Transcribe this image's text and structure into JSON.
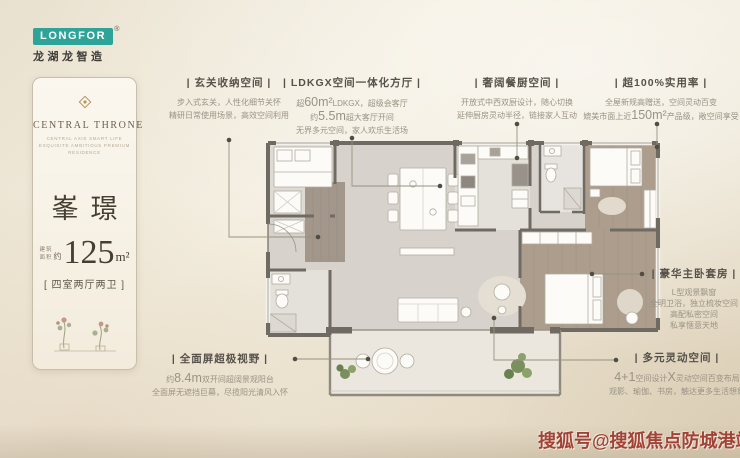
{
  "colors": {
    "logo_teal": "#2ea397",
    "watermark_red": "#9e372b",
    "title_text": "#56514a",
    "body_text": "#9a9384"
  },
  "logo": {
    "wordmark": "LONGFOR",
    "registered": "®",
    "subtitle": "龙湖龙智造"
  },
  "card": {
    "brand": "CENTRAL THRONE",
    "tagline1": "CENTRAL AXIS SMART LIFE",
    "tagline2": "EXQUISITE AMBITIOUS PREMIUM RESIDENCE",
    "name": "峯璟",
    "area_label_1": "建筑",
    "area_label_2": "面积",
    "area_approx": "约",
    "area_value": "125",
    "area_unit": "m²",
    "layout": "[ 四室两厅两卫 ]"
  },
  "annotations": [
    {
      "id": "entry-storage",
      "title": "| 玄关收纳空间 |",
      "lines": [
        [
          {
            "t": "步入式玄关，人性化细节关怀"
          }
        ],
        [
          {
            "t": "精研日常使用场景，高效空间利用"
          }
        ]
      ]
    },
    {
      "id": "ldkgx-hall",
      "title": "| LDKGX空间一体化方厅 |",
      "lines": [
        [
          {
            "t": "超"
          },
          {
            "t": "60m²",
            "big": true
          },
          {
            "t": "LDKGX，超级会客厅"
          }
        ],
        [
          {
            "t": "约"
          },
          {
            "t": "5.5m",
            "big": true
          },
          {
            "t": "超大客厅开间"
          }
        ],
        [
          {
            "t": "无界多元空间，家人欢乐生活场"
          }
        ]
      ]
    },
    {
      "id": "kitchen-dining",
      "title": "| 奢阔餐厨空间 |",
      "lines": [
        [
          {
            "t": "开放式中西双厨设计，随心切换"
          }
        ],
        [
          {
            "t": "延伸厨房灵动半径，链接家人互动"
          }
        ]
      ]
    },
    {
      "id": "efficiency",
      "title": "| 超100%实用率 |",
      "lines": [
        [
          {
            "t": "全屋新规高赠送，空间灵动百变"
          }
        ],
        [
          {
            "t": "媲美市面上近"
          },
          {
            "t": "150m²",
            "big": true
          },
          {
            "t": "产品级，敞空间享受"
          }
        ]
      ]
    },
    {
      "id": "master-suite",
      "title": "| 豪华主卧套房 |",
      "lines": [
        [
          {
            "t": "L型观景飘窗"
          }
        ],
        [
          {
            "t": "全明卫浴，独立梳妆空间"
          }
        ],
        [
          {
            "t": "高配私密空间"
          }
        ],
        [
          {
            "t": "私享惬意天地"
          }
        ]
      ]
    },
    {
      "id": "flex-space",
      "title": "| 多元灵动空间 |",
      "lines": [
        [
          {
            "t": "4+1",
            "big": true
          },
          {
            "t": "空间设计"
          },
          {
            "t": "X",
            "big": true
          },
          {
            "t": "灵动空间百变布局"
          }
        ],
        [
          {
            "t": "观影、瑜伽、书房，触达更多生活想象"
          }
        ]
      ]
    },
    {
      "id": "panorama-balcony",
      "title": "| 全面屏超极视野 |",
      "lines": [
        [
          {
            "t": "约"
          },
          {
            "t": "8.4m",
            "big": true
          },
          {
            "t": "双开间超阔景观阳台"
          }
        ],
        [
          {
            "t": "全面屏无遮挡巨幕，尽揽阳光清风入怀"
          }
        ]
      ]
    }
  ],
  "watermark": {
    "text": "搜狐号@搜狐焦点防城港站"
  }
}
